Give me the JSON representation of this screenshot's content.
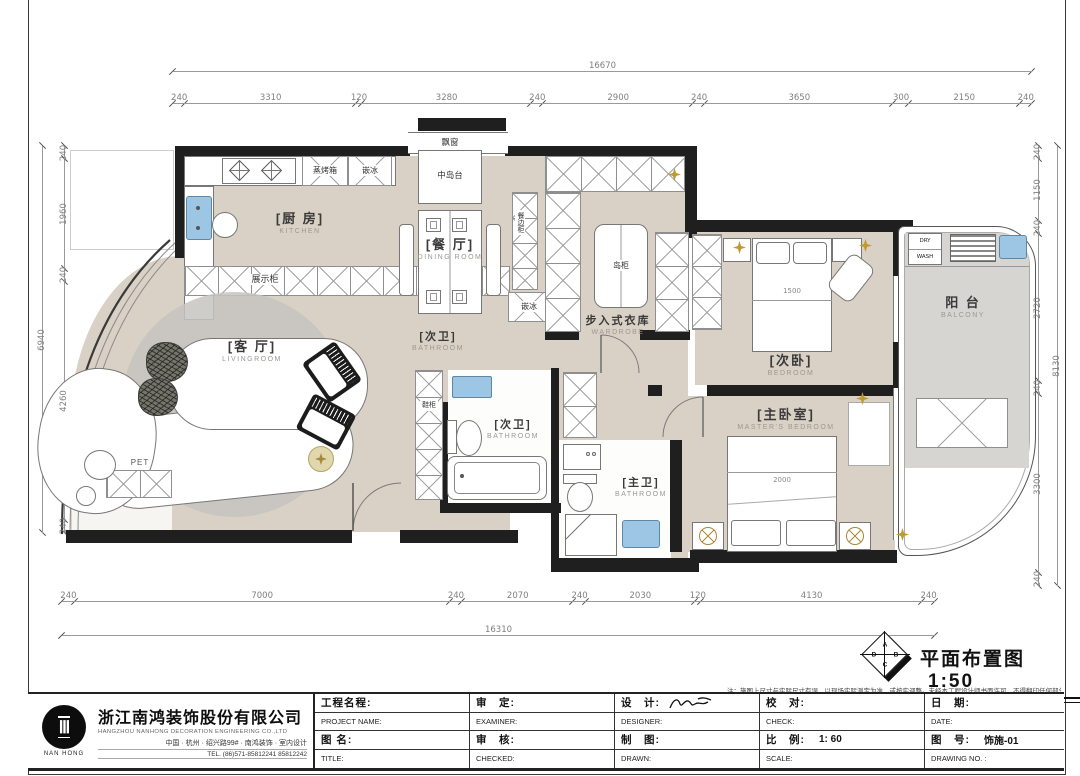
{
  "drawing": {
    "plan_title": "平面布置图",
    "plan_scale": "1:50",
    "zone_letters": [
      "A",
      "B",
      "C",
      "D"
    ],
    "note": "注：施图上尺寸与实际尺寸有误，以现场实际测定为准，或按实调整。未经本工程设计师书面许可，不得翻印任何部分。"
  },
  "dims": {
    "top_total": [
      "16670"
    ],
    "top_segments": [
      "240",
      "3310",
      "120",
      "3280",
      "240",
      "2900",
      "240",
      "3650",
      "300",
      "2150",
      "240"
    ],
    "left_total": [
      "6940"
    ],
    "left_segments": [
      "240",
      "1960",
      "240",
      "4260",
      "240"
    ],
    "right_total": [
      "8130"
    ],
    "right_segments": [
      "240",
      "1150",
      "240",
      "2720",
      "240",
      "3300",
      "240"
    ],
    "bottom_total": [
      "16310"
    ],
    "bottom_segments": [
      "240",
      "7000",
      "240",
      "2070",
      "240",
      "2030",
      "120",
      "4130",
      "240"
    ]
  },
  "rooms": {
    "kitchen_zh": "[厨 房]",
    "kitchen_en": "KITCHEN",
    "dining_zh": "[餐 厅]",
    "dining_en": "DINING ROOM",
    "living_zh": "[客 厅]",
    "living_en": "LIVINGROOM",
    "wardrobe_zh": "步入式衣库",
    "wardrobe_en": "WARDROBE",
    "bath2a_zh": "[次卫]",
    "bath2a_en": "BATHROOM",
    "bath2b_zh": "[次卫]",
    "bath2b_en": "BATHROOM",
    "master_bath_zh": "[主卫]",
    "master_bath_en": "BATHROOM",
    "bedroom2_zh": "[次卧]",
    "bedroom2_en": "BEDROOM",
    "master_bedroom_zh": "[主卧室]",
    "master_bedroom_en": "MASTER'S BEDROOM",
    "balcony_zh": "阳 台",
    "balcony_en": "BALCONY"
  },
  "annotations": {
    "bay_window": "飘窗",
    "center_island": "中岛台",
    "steam_oven": "蒸烤箱",
    "built_in_fridge_top": "嵌冰",
    "built_in_fridge_side": "嵌冰",
    "display_cabinet": "展示柜",
    "dining_side_cabinet": "餐边柜",
    "island_cabinet": "岛柜",
    "shoe_cabinet": "鞋柜",
    "pet_area": "PET",
    "dryer": "DRY",
    "washer": "WASH",
    "bed2_width": "1500",
    "master_bed_width": "2000"
  },
  "icons": {
    "spotlight": "four-point-star",
    "ceiling-fan": "crossed-circle"
  },
  "company": {
    "name_zh": "浙江南鸿装饰股份有限公司",
    "name_en": "HANGZHOU NANHONG DECORATION ENGINEERING CO.,LTD",
    "logo_text": "NAN HONG",
    "address": "中国 · 杭州 · 绍兴路99# · 南鸿装饰 · 室内设计",
    "tel": "TEL.  (86)571-85812241  85812242"
  },
  "title_block": {
    "r1_zh": [
      "工程名程:",
      "审　定:",
      "设　计:",
      "校　对:",
      "日　期:"
    ],
    "r2_en": [
      "PROJECT NAME:",
      "EXAMINER:",
      "DESIGNER:",
      "CHECK:",
      "DATE:"
    ],
    "r3_zh": [
      "图 名:",
      "审　核:",
      "制　图:",
      "比　例:",
      "图　号:"
    ],
    "r3_val": [
      "",
      "",
      "",
      "1: 60",
      "饰施-01"
    ],
    "r4_en": [
      "TITLE:",
      "CHECKED:",
      "DRAWN:",
      "SCALE:",
      "DRAWING NO. :"
    ]
  },
  "colors": {
    "floor": "#d9d1c5",
    "balcony_floor": "#d6d5d2",
    "wall": "#1f1f1f",
    "fixture_blue": "#9cc6e4",
    "accent_gold": "#c2992e"
  }
}
